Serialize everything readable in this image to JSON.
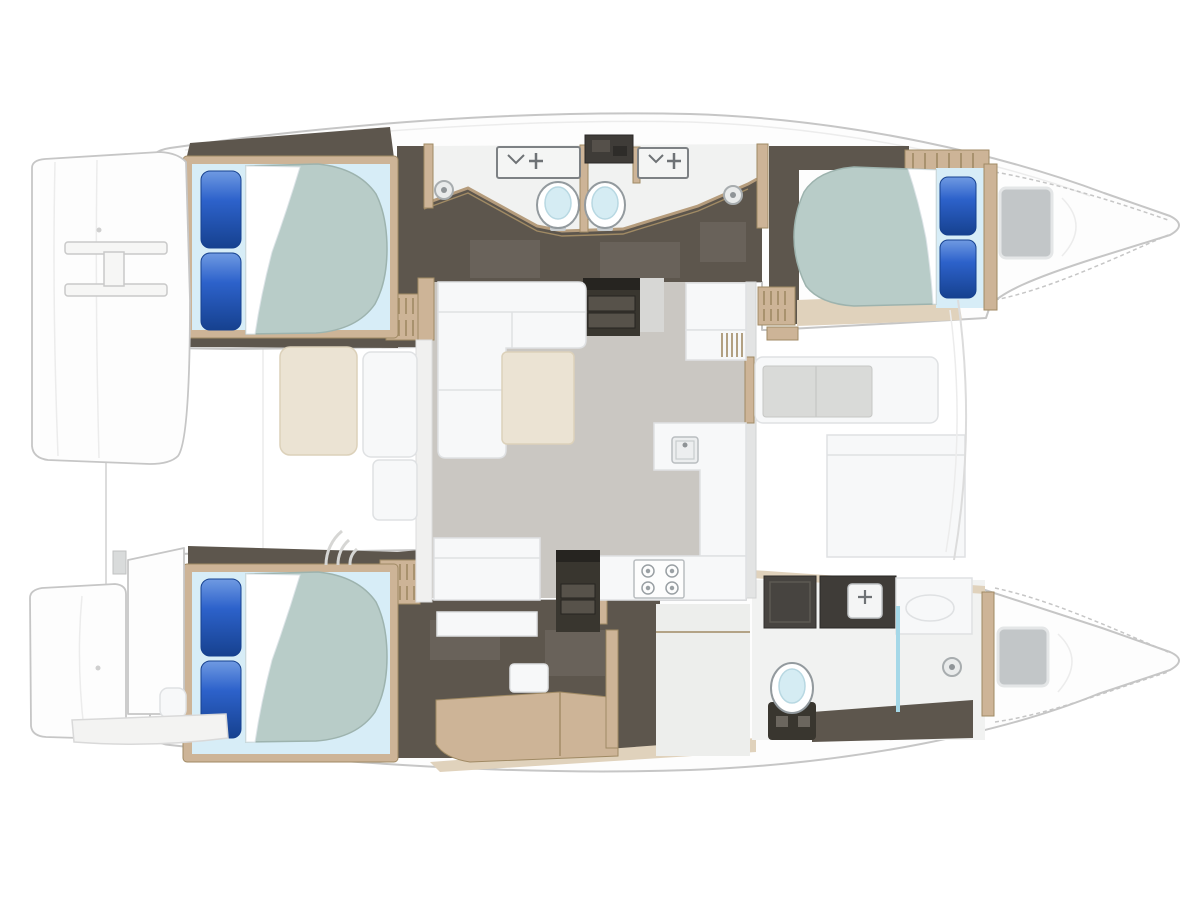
{
  "page": {
    "background": "#ffffff",
    "kind": "catamaran-yacht-floor-plan",
    "view": "overhead-deck-layout",
    "orientation": "bows-to-the-right"
  },
  "plan": {
    "hulls": [
      {
        "id": "top-hull",
        "cabins": [
          {
            "id": "aft-guest-cabin",
            "berth": "double-bed",
            "pillows": 2
          },
          {
            "id": "forward-guest-cabin",
            "berth": "double-bed",
            "pillows": 2
          }
        ],
        "bathrooms": [
          {
            "id": "guest-bathroom-aft",
            "fixtures": [
              "sink-unit",
              "toilet",
              "shower-drain"
            ]
          },
          {
            "id": "guest-bathroom-forward",
            "fixtures": [
              "sink-unit",
              "toilet",
              "shower-drain"
            ]
          }
        ],
        "bow": [
          "deck-hatch"
        ]
      },
      {
        "id": "bottom-hull",
        "cabins": [
          {
            "id": "owner-cabin",
            "berth": "double-bed",
            "pillows": 2,
            "furniture": [
              "vanity-desk",
              "stool",
              "louvered-locker",
              "storage-cabinet"
            ]
          }
        ],
        "bathrooms": [
          {
            "id": "owner-bathroom",
            "fixtures": [
              "mirror-cabinet",
              "sink-counter",
              "vanity-counter",
              "toilet",
              "shower-glass",
              "shower-drain"
            ]
          }
        ],
        "bow": [
          "deck-hatch"
        ]
      }
    ],
    "bridgedeck": {
      "salon": [
        "l-shaped-sofa",
        "coffee-table",
        "bench-seat",
        "galley-l-counter",
        "galley-sink",
        "stove",
        "companionway-steps-top",
        "companionway-steps-bottom",
        "louvered-cabinet"
      ],
      "aft-deck": [
        "lounge-cushion-cream",
        "lounge-seat-white",
        "seat-box",
        "fan-steps"
      ],
      "foredeck": [
        "bench-with-grey-cushion",
        "storage-box",
        "louvered-locker"
      ],
      "sterns": [
        "swim-platform-top",
        "swim-platform-bottom",
        "boarding-ladder",
        "transom-step-band"
      ]
    },
    "counts": {
      "double_beds": 3,
      "blue_pillows": 6,
      "toilets": 3,
      "bathroom_sinks": 3,
      "shower_drains": 3,
      "bow_hatches": 2,
      "stoves": 1
    }
  },
  "colors": {
    "hull_fill": "#fdfdfd",
    "hull_stroke": "#c6c6c6",
    "deck_line": "#dcdcdc",
    "floor_dark": "#5d564d",
    "floor_panel": "#69625a",
    "step_dark": "#39362f",
    "step_lip": "#262420",
    "step_tread": "#57524a",
    "wood": "#cdb497",
    "wood_dark": "#a08a64",
    "wood_light": "#e0d2bc",
    "wood_trim": "#b59c7c",
    "salon_floor": "#cac7c2",
    "bath_floor": "#f1f2f1",
    "dressing_floor": "#edeeec",
    "furniture_white": "#f7f8f9",
    "furniture_stroke": "#dfe1e3",
    "table_cream": "#ebe3d3",
    "cream_stroke": "#dcd1ba",
    "mattress": "#b8ccc8",
    "mattress_stroke": "#9db3ae",
    "head_band": "#d7edf7",
    "sheet": "#ffffff",
    "pillow": "#2d62cb",
    "pillow_deep": "#16418f",
    "pillow_light": "#6f9ae2",
    "cushion": "#d9dad8",
    "hatch": "#c2c6c8",
    "hatch_stroke": "#e4e6e7",
    "glass": "#a5d8e8",
    "fixture": "#939a9e",
    "toilet_bowl": "#d5ecf3",
    "counter_dark": "#3f3c38",
    "mirror_dark": "#474440",
    "grey_band": "#d7d7d5",
    "box_grey": "#d9dbdb"
  }
}
